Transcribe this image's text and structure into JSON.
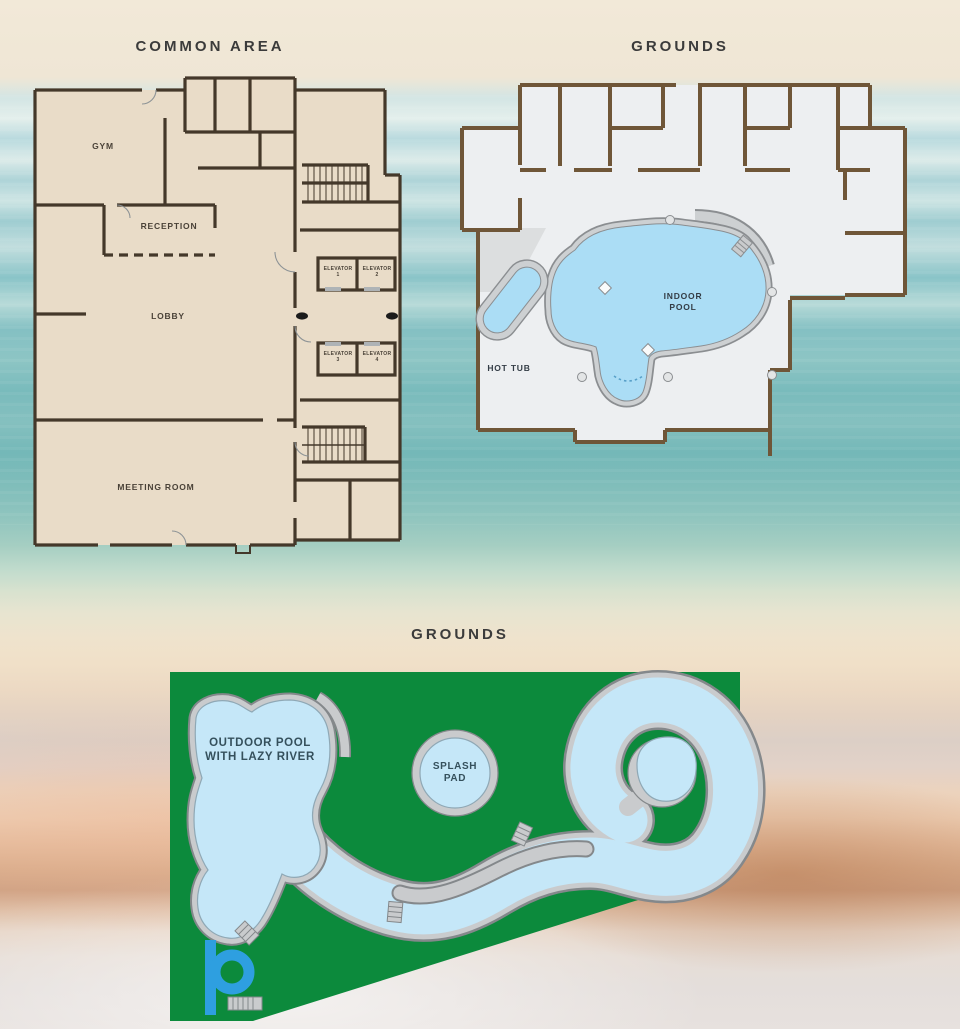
{
  "titles": {
    "common_area": "COMMON AREA",
    "grounds_indoor": "GROUNDS",
    "grounds_outdoor": "GROUNDS"
  },
  "common_area": {
    "gym": "GYM",
    "reception": "RECEPTION",
    "lobby": "LOBBY",
    "meeting_room": "MEETING ROOM",
    "elevators": [
      {
        "label": "ELEVATOR",
        "number": "1"
      },
      {
        "label": "ELEVATOR",
        "number": "2"
      },
      {
        "label": "ELEVATOR",
        "number": "3"
      },
      {
        "label": "ELEVATOR",
        "number": "4"
      }
    ]
  },
  "grounds_indoor": {
    "hot_tub": "HOT TUB",
    "indoor_pool": [
      "INDOOR",
      "POOL"
    ]
  },
  "grounds_outdoor": {
    "outdoor_pool": [
      "OUTDOOR POOL",
      "WITH LAZY RIVER"
    ],
    "splash_pad": [
      "SPLASH",
      "PAD"
    ]
  },
  "colors": {
    "grass_green": "#0c8a3c",
    "pool_water": "#c5e7f8",
    "indoor_water": "#abddf5",
    "concrete_deck": "#c9cbcd",
    "deck_outline": "#84888b",
    "wall_dark_brown": "#44382a",
    "wall_brown": "#6f5638",
    "floor_tan": "#e9dcc8",
    "floor_gray": "#edeff1",
    "slide_blue": "#2e9fe0",
    "title_text": "#3b3b3b"
  }
}
